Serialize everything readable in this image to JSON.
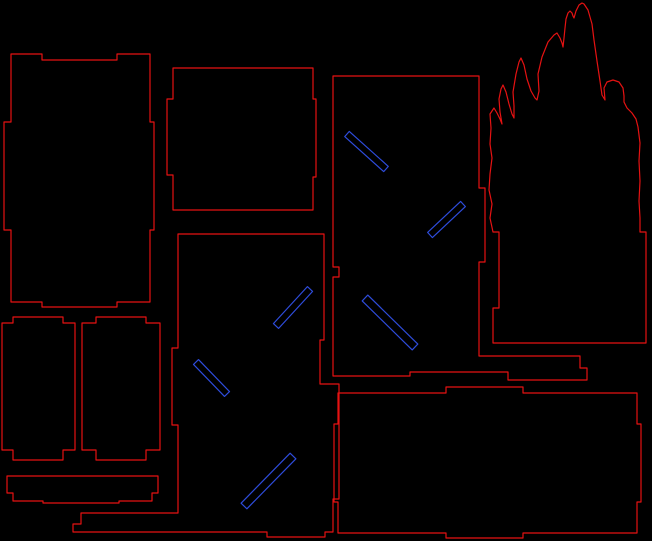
{
  "canvas": {
    "width": 652,
    "height": 541,
    "background": "#000000"
  },
  "drawing": {
    "cut_color": "#e51212",
    "slot_color": "#2e4cdb",
    "stroke_width": 1.2,
    "pieces": [
      {
        "name": "side-panel-left",
        "points": [
          [
            11,
            54
          ],
          [
            42,
            54
          ],
          [
            42,
            60
          ],
          [
            117,
            60
          ],
          [
            117,
            54
          ],
          [
            150,
            54
          ],
          [
            150,
            122
          ],
          [
            154,
            122
          ],
          [
            154,
            230
          ],
          [
            150,
            230
          ],
          [
            150,
            302
          ],
          [
            117,
            302
          ],
          [
            117,
            307
          ],
          [
            42,
            307
          ],
          [
            42,
            302
          ],
          [
            11,
            302
          ],
          [
            11,
            230
          ],
          [
            4,
            230
          ],
          [
            4,
            122
          ],
          [
            11,
            122
          ]
        ]
      },
      {
        "name": "top-panel",
        "points": [
          [
            173,
            68
          ],
          [
            313,
            68
          ],
          [
            313,
            99
          ],
          [
            316,
            99
          ],
          [
            316,
            177
          ],
          [
            313,
            177
          ],
          [
            313,
            210
          ],
          [
            173,
            210
          ],
          [
            173,
            175
          ],
          [
            167,
            175
          ],
          [
            167,
            99
          ],
          [
            173,
            99
          ]
        ]
      },
      {
        "name": "front-panel",
        "points": [
          [
            333,
            76
          ],
          [
            479,
            76
          ],
          [
            479,
            188
          ],
          [
            485,
            188
          ],
          [
            485,
            262
          ],
          [
            479,
            262
          ],
          [
            479,
            356
          ],
          [
            580,
            356
          ],
          [
            580,
            368
          ],
          [
            587,
            368
          ],
          [
            587,
            380
          ],
          [
            508,
            380
          ],
          [
            508,
            372
          ],
          [
            410,
            372
          ],
          [
            410,
            376
          ],
          [
            333,
            376
          ],
          [
            333,
            277
          ],
          [
            339,
            277
          ],
          [
            339,
            267
          ],
          [
            333,
            267
          ]
        ]
      },
      {
        "name": "back-panel",
        "points": [
          [
            178,
            234
          ],
          [
            324,
            234
          ],
          [
            324,
            340
          ],
          [
            320,
            340
          ],
          [
            320,
            384
          ],
          [
            339,
            384
          ],
          [
            339,
            499
          ],
          [
            333,
            499
          ],
          [
            333,
            532
          ],
          [
            325,
            532
          ],
          [
            325,
            537
          ],
          [
            267,
            537
          ],
          [
            267,
            532
          ],
          [
            73,
            532
          ],
          [
            73,
            524
          ],
          [
            81,
            524
          ],
          [
            81,
            513
          ],
          [
            178,
            513
          ],
          [
            178,
            425
          ],
          [
            172,
            425
          ],
          [
            172,
            348
          ],
          [
            178,
            348
          ]
        ]
      },
      {
        "name": "base-panel",
        "points": [
          [
            338,
            393
          ],
          [
            446,
            393
          ],
          [
            446,
            387
          ],
          [
            523,
            387
          ],
          [
            523,
            393
          ],
          [
            637,
            393
          ],
          [
            637,
            424
          ],
          [
            641,
            424
          ],
          [
            641,
            502
          ],
          [
            637,
            502
          ],
          [
            637,
            533
          ],
          [
            523,
            533
          ],
          [
            523,
            538
          ],
          [
            446,
            538
          ],
          [
            446,
            533
          ],
          [
            338,
            533
          ],
          [
            338,
            502
          ],
          [
            334,
            502
          ],
          [
            334,
            424
          ],
          [
            338,
            424
          ]
        ]
      },
      {
        "name": "door-panel-left",
        "points": [
          [
            13,
            317
          ],
          [
            63,
            317
          ],
          [
            63,
            323
          ],
          [
            75,
            323
          ],
          [
            75,
            450
          ],
          [
            63,
            450
          ],
          [
            63,
            460
          ],
          [
            13,
            460
          ],
          [
            13,
            450
          ],
          [
            2,
            450
          ],
          [
            2,
            323
          ],
          [
            13,
            323
          ]
        ]
      },
      {
        "name": "door-panel-right",
        "points": [
          [
            96,
            317
          ],
          [
            146,
            317
          ],
          [
            146,
            323
          ],
          [
            160,
            323
          ],
          [
            160,
            450
          ],
          [
            146,
            450
          ],
          [
            146,
            460
          ],
          [
            96,
            460
          ],
          [
            96,
            450
          ],
          [
            82,
            450
          ],
          [
            82,
            323
          ],
          [
            96,
            323
          ]
        ]
      },
      {
        "name": "shelf-strip",
        "points": [
          [
            7,
            476
          ],
          [
            158,
            476
          ],
          [
            158,
            493
          ],
          [
            152,
            493
          ],
          [
            152,
            501
          ],
          [
            119,
            501
          ],
          [
            119,
            503
          ],
          [
            43,
            503
          ],
          [
            43,
            501
          ],
          [
            13,
            501
          ],
          [
            13,
            493
          ],
          [
            7,
            493
          ]
        ]
      },
      {
        "name": "flame-cutout",
        "points": [
          [
            493,
            232
          ],
          [
            490,
            218
          ],
          [
            492,
            204
          ],
          [
            489,
            190
          ],
          [
            490,
            174
          ],
          [
            492,
            158
          ],
          [
            490,
            144
          ],
          [
            491,
            128
          ],
          [
            490,
            114
          ],
          [
            494,
            108
          ],
          [
            497,
            113
          ],
          [
            500,
            119
          ],
          [
            502,
            124
          ],
          [
            500,
            112
          ],
          [
            499,
            99
          ],
          [
            501,
            89
          ],
          [
            503,
            85
          ],
          [
            506,
            92
          ],
          [
            509,
            104
          ],
          [
            512,
            114
          ],
          [
            514,
            118
          ],
          [
            514,
            106
          ],
          [
            513,
            92
          ],
          [
            516,
            74
          ],
          [
            519,
            62
          ],
          [
            521,
            58
          ],
          [
            524,
            65
          ],
          [
            527,
            79
          ],
          [
            531,
            91
          ],
          [
            535,
            98
          ],
          [
            537,
            100
          ],
          [
            539,
            91
          ],
          [
            538,
            74
          ],
          [
            542,
            57
          ],
          [
            548,
            42
          ],
          [
            554,
            35
          ],
          [
            557,
            33
          ],
          [
            560,
            38
          ],
          [
            562,
            43
          ],
          [
            563,
            47
          ],
          [
            564,
            38
          ],
          [
            565,
            28
          ],
          [
            566,
            19
          ],
          [
            568,
            13
          ],
          [
            570,
            11
          ],
          [
            572,
            13
          ],
          [
            573,
            16
          ],
          [
            574,
            18
          ],
          [
            576,
            11
          ],
          [
            579,
            5
          ],
          [
            582,
            3
          ],
          [
            584,
            4
          ],
          [
            588,
            10
          ],
          [
            592,
            24
          ],
          [
            594,
            40
          ],
          [
            597,
            61
          ],
          [
            600,
            81
          ],
          [
            602,
            95
          ],
          [
            605,
            100
          ],
          [
            604,
            88
          ],
          [
            607,
            82
          ],
          [
            613,
            80
          ],
          [
            619,
            82
          ],
          [
            623,
            88
          ],
          [
            624,
            96
          ],
          [
            624,
            102
          ],
          [
            627,
            108
          ],
          [
            632,
            113
          ],
          [
            636,
            119
          ],
          [
            638,
            127
          ],
          [
            640,
            143
          ],
          [
            639,
            161
          ],
          [
            640,
            181
          ],
          [
            639,
            201
          ],
          [
            640,
            218
          ],
          [
            640,
            232
          ],
          [
            646,
            232
          ],
          [
            646,
            343
          ],
          [
            493,
            343
          ],
          [
            493,
            308
          ],
          [
            499,
            308
          ],
          [
            499,
            232
          ]
        ]
      }
    ],
    "slots": [
      {
        "name": "slot-front-upper",
        "x1": 347,
        "y1": 134,
        "x2": 386,
        "y2": 169,
        "width": 7
      },
      {
        "name": "slot-front-middle",
        "x1": 430,
        "y1": 235,
        "x2": 463,
        "y2": 204,
        "width": 7
      },
      {
        "name": "slot-front-lower",
        "x1": 365,
        "y1": 298,
        "x2": 415,
        "y2": 347,
        "width": 8
      },
      {
        "name": "slot-back-upper",
        "x1": 276,
        "y1": 326,
        "x2": 310,
        "y2": 289,
        "width": 7
      },
      {
        "name": "slot-back-middle",
        "x1": 196,
        "y1": 362,
        "x2": 227,
        "y2": 394,
        "width": 7
      },
      {
        "name": "slot-back-lower",
        "x1": 244,
        "y1": 506,
        "x2": 293,
        "y2": 456,
        "width": 8
      }
    ]
  }
}
